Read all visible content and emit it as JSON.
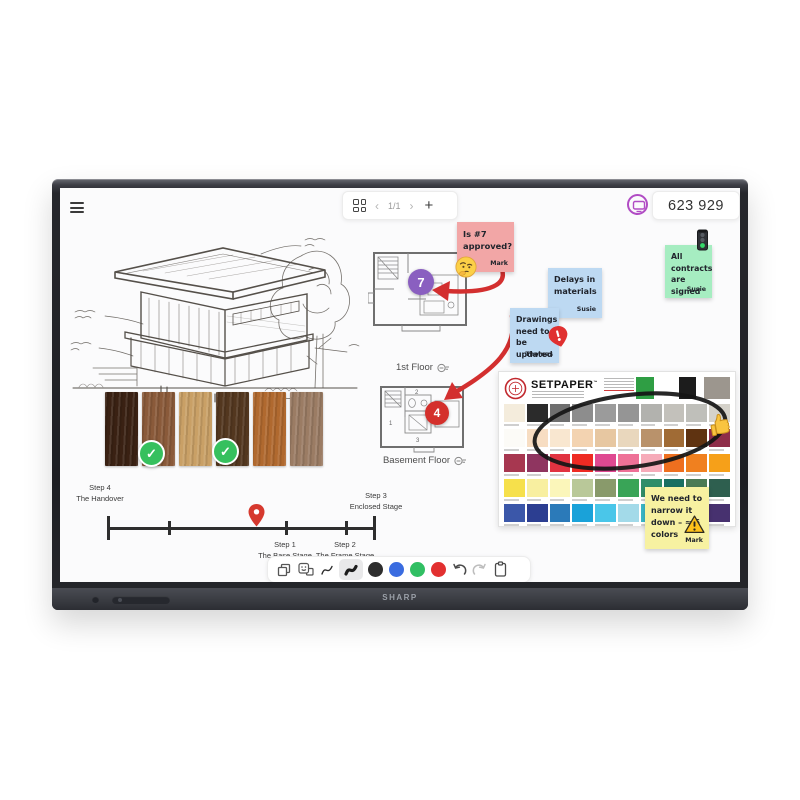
{
  "device": {
    "brand": "SHARP"
  },
  "topbar": {
    "pager": {
      "page_indicator": "1/1"
    },
    "session": {
      "code": "623 929",
      "icon_color": "#b14cc4"
    }
  },
  "icons": {
    "chevron_left": "‹",
    "chevron_right": "›",
    "plus": "+",
    "check": "✓",
    "minus": "−",
    "exclaim": "!"
  },
  "board": {
    "stickies": {
      "approval": {
        "text": "Is #7 approved?",
        "author": "Mark",
        "bg": "#f2a6a6",
        "emoji": "thinking-face"
      },
      "delays": {
        "text": "Delays in materials",
        "author": "Susie",
        "bg": "#bdd9f2"
      },
      "drawings": {
        "text": "Drawings need to be updated",
        "author": "Thomas",
        "bg": "#bdd9f2",
        "badge": "alert"
      },
      "contracts": {
        "text": "All contracts are signed",
        "author": "Susie",
        "bg": "#a6edc1",
        "emoji": "traffic-light"
      },
      "colors_note": {
        "text": "We need to narrow it down – ≈ 6 colors",
        "author": "Mark",
        "bg": "#f7f1a1",
        "emoji": "warning"
      }
    },
    "floorplans": {
      "first": {
        "label": "1st Floor",
        "marker": "7",
        "marker_color": "#8a5fc0"
      },
      "basement": {
        "label": "Basement Floor",
        "marker": "4",
        "marker_color": "#d4302c",
        "rooms": [
          "1",
          "2",
          "3"
        ]
      }
    },
    "timeline": {
      "pin_color": "#d6392e",
      "steps": [
        {
          "step": "Step 1",
          "name": "The Base Stage"
        },
        {
          "step": "Step 2",
          "name": "The Frame Stage"
        },
        {
          "step": "Step 3",
          "name": "Enclosed Stage"
        },
        {
          "step": "Step 4",
          "name": "The Handover"
        }
      ]
    },
    "wood_samples": [
      {
        "color": "#3a2113",
        "approved": false
      },
      {
        "color": "#8a5a3a",
        "approved": false
      },
      {
        "color": "#c9a066",
        "approved": true
      },
      {
        "color": "#53371f",
        "approved": false
      },
      {
        "color": "#b0692f",
        "approved": true
      },
      {
        "color": "#9b7c64",
        "approved": false
      }
    ],
    "palette_card": {
      "title": "SETPAPER",
      "tm": "™",
      "header_swatches": [
        "#2f9e44",
        "#1c1c1c",
        "#9c968e"
      ],
      "swatches": [
        "#f4ecdc",
        "#2b2b2b",
        "#6f6f6f",
        "#8d8d8d",
        "#9b9b9b",
        "#959595",
        "#b2b2ae",
        "#c3c1bb",
        "#bfbfba",
        "#d5d2ca",
        "#fcfbf7",
        "#f7ddc2",
        "#f9e7d0",
        "#f3d3b1",
        "#e7c7a1",
        "#e9d7bd",
        "#b9926b",
        "#a06b35",
        "#5f3311",
        "#8e2d49",
        "#a73750",
        "#8f3560",
        "#e13341",
        "#ee2b23",
        "#df4991",
        "#ee7197",
        "#f6abb9",
        "#ee6f1f",
        "#f0801f",
        "#f6a019",
        "#f6e04b",
        "#f8efa0",
        "#fbf6ba",
        "#b9c899",
        "#899a6b",
        "#39a457",
        "#2f8d69",
        "#1a6f62",
        "#4b7b55",
        "#2e5f4f",
        "#3b57a9",
        "#2c3e91",
        "#2b7ab9",
        "#1aa2d9",
        "#4ac6e9",
        "#a3dae9",
        "#3ab6c6",
        "#2b6fa1",
        "#5d3b8f",
        "#47316f"
      ],
      "annotation": "marker-ellipse",
      "reaction": "thumbs-up"
    },
    "marker_color": "#d32f2f"
  },
  "toolbar": {
    "selected_tool": "pen-thick",
    "colors": [
      {
        "color": "#2e2e2e",
        "selected": true
      },
      {
        "color": "#3a6ce0",
        "selected": false
      },
      {
        "color": "#31bf63",
        "selected": false
      },
      {
        "color": "#e23030",
        "selected": false
      }
    ]
  }
}
